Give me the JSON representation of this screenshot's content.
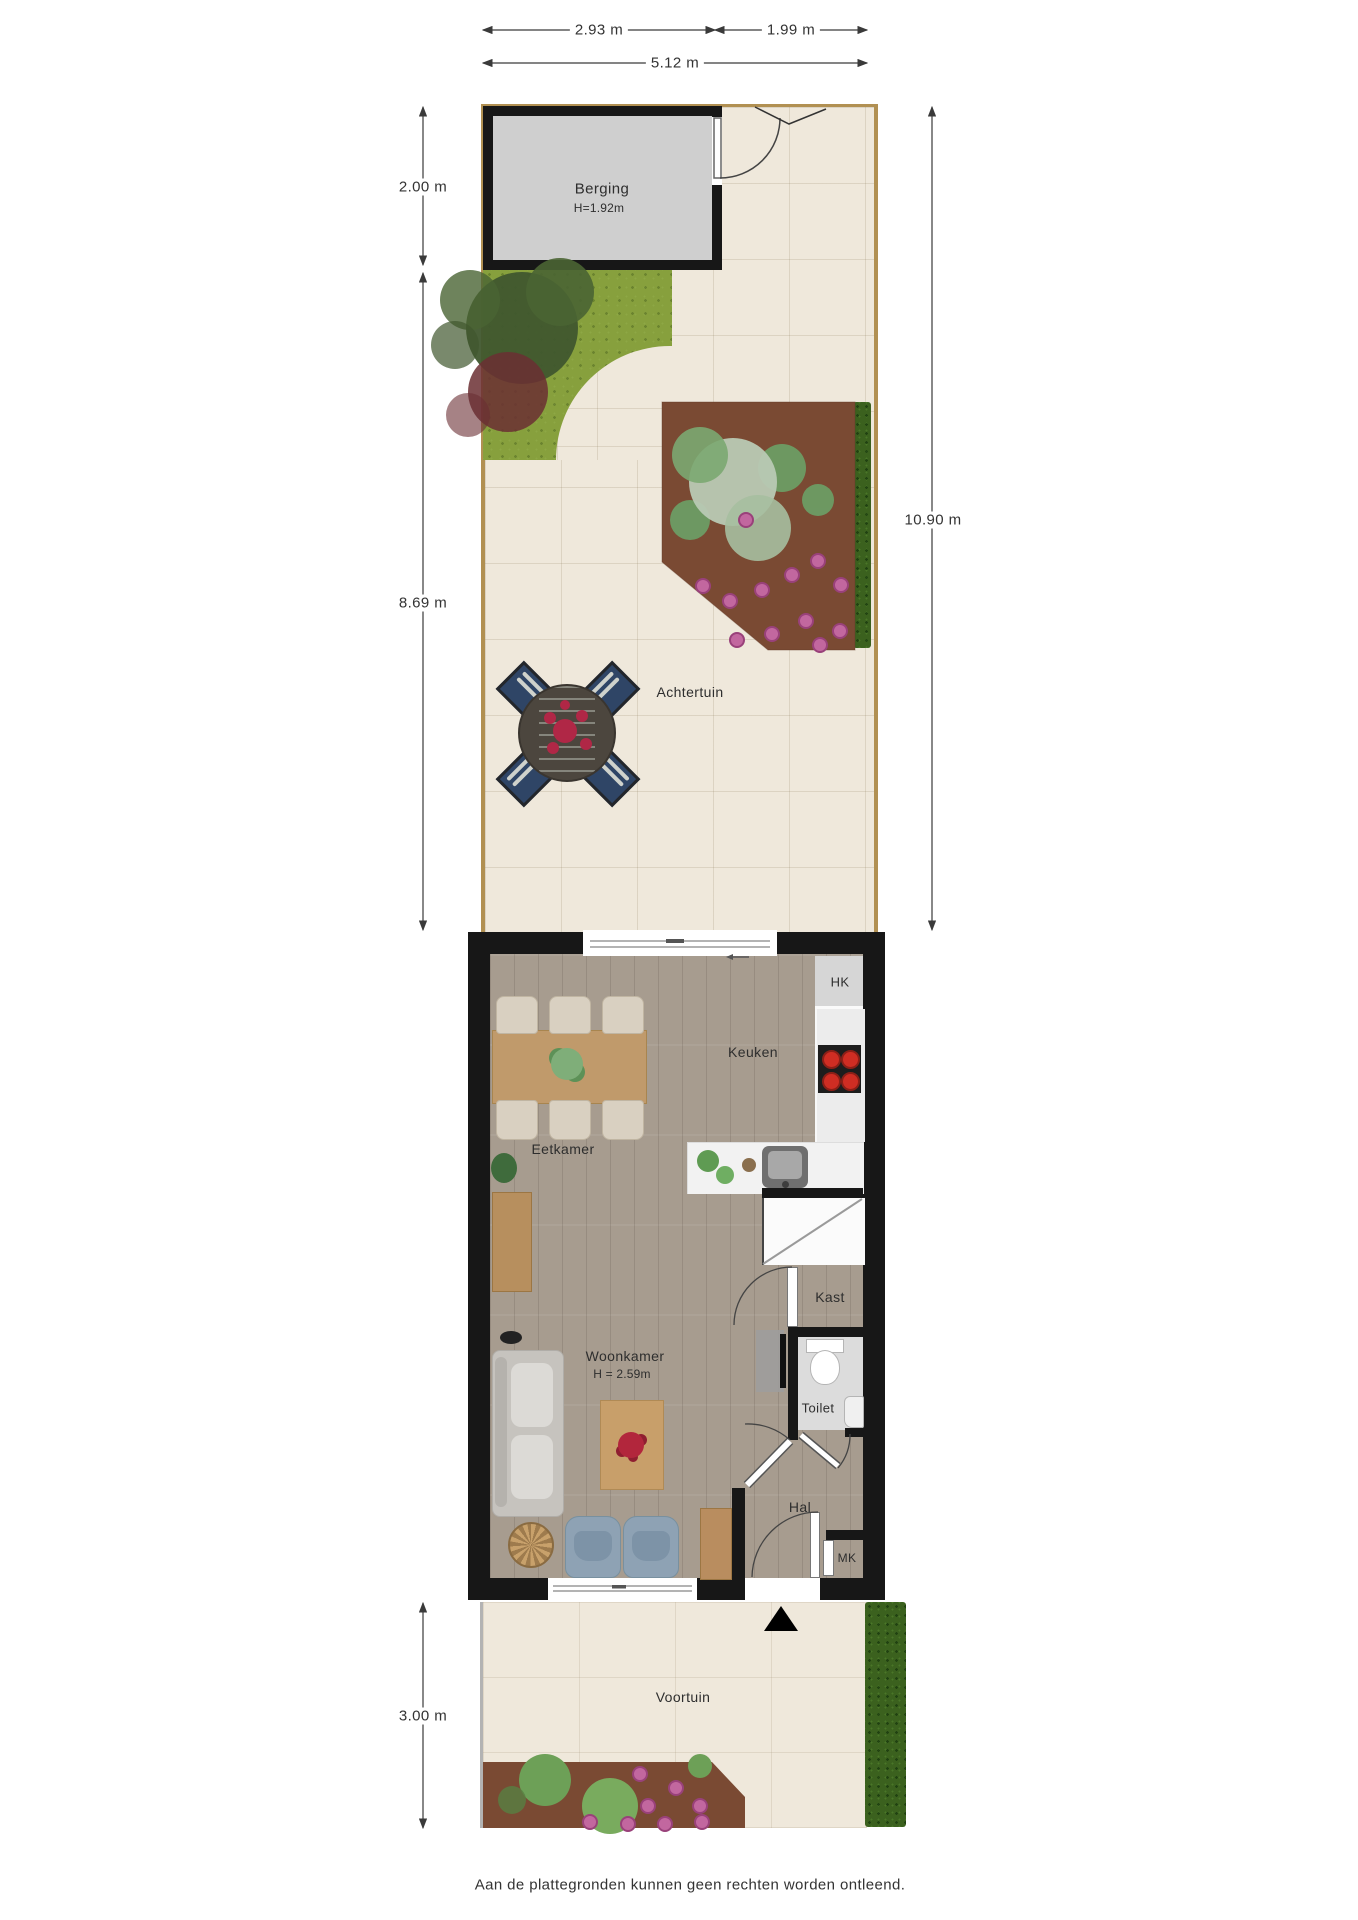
{
  "labels": {
    "berging": {
      "name": "Berging",
      "height": "H=1.92m"
    },
    "achtertuin": "Achtertuin",
    "keuken": "Keuken",
    "hk": "HK",
    "eetkamer": "Eetkamer",
    "kast": "Kast",
    "woonkamer": {
      "name": "Woonkamer",
      "height": "H = 2.59m"
    },
    "toilet": "Toilet",
    "hal": "Hal",
    "mk": "MK",
    "voortuin": "Voortuin"
  },
  "dimensions": {
    "top_left": "2.93 m",
    "top_right": "1.99 m",
    "top_total": "5.12 m",
    "left_berging": "2.00 m",
    "left_garden": "8.69 m",
    "right_total": "10.90 m",
    "left_voortuin": "3.00 m"
  },
  "disclaimer": "Aan de plattegronden kunnen geen rechten worden ontleend.",
  "colors": {
    "paving": "#efe8db",
    "grass": "#87a03d",
    "bed": "#7a4a33",
    "hedge": "#3b611e",
    "wall": "#171717",
    "floor": "#a79c8f",
    "fence": "#b19052",
    "shed-interior": "#cfcfcf",
    "burner-red": "#cf2d23",
    "toilet-floor": "#dcdcdc"
  }
}
